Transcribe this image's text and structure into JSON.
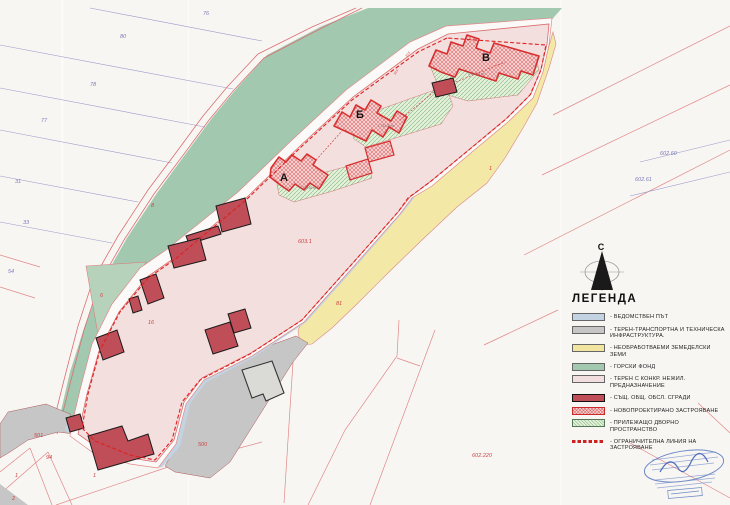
{
  "compass": {
    "label": "С"
  },
  "legend": {
    "title": "ЛЕГЕНДА",
    "items": [
      {
        "swatch": "road",
        "label": "- ВЕДОМСТВЕН ПЪТ"
      },
      {
        "swatch": "infra",
        "label": "- ТЕРЕН-ТРАНСПОРТНА И ТЕХНИЧЕСКА ИНФРАСТРУКТУРА."
      },
      {
        "swatch": "agri",
        "label": "- НЕОБРАБОТВАЕМИ ЗЕМЕДЕЛСКИ ЗЕМИ"
      },
      {
        "swatch": "forest",
        "label": "- ГОРСКИ ФОНД"
      },
      {
        "swatch": "terrain",
        "label": "- ТЕРЕН С КОНКР. НЕЖИЛ. ПРЕДНАЗНАЧЕНИЕ"
      },
      {
        "swatch": "existing",
        "label": "- СЪЩ. ОБЩ. ОБСЛ. СГРАДИ"
      },
      {
        "swatch": "new",
        "label": "- НОВОПРОЕКТИРАНО ЗАСТРОЯВАНЕ"
      },
      {
        "swatch": "yard",
        "label": "- ПРИЛЕЖАЩО ДВОРНО ПРОСТРАНСТВО"
      },
      {
        "swatch": "limit",
        "label": "- ОГРАНИЧИТЕЛНА ЛИНИЯ НА ЗАСТРОЯВАНЕ"
      }
    ]
  },
  "map": {
    "labels": [
      {
        "text": "76",
        "x": 203,
        "y": 15,
        "cls": "parcel-blue"
      },
      {
        "text": "80",
        "x": 120,
        "y": 38,
        "cls": "parcel-blue"
      },
      {
        "text": "78",
        "x": 90,
        "y": 86,
        "cls": "parcel-blue"
      },
      {
        "text": "77",
        "x": 41,
        "y": 122,
        "cls": "parcel-blue"
      },
      {
        "text": "31",
        "x": 15,
        "y": 183,
        "cls": "parcel-blue"
      },
      {
        "text": "33",
        "x": 23,
        "y": 224,
        "cls": "parcel-blue"
      },
      {
        "text": "54",
        "x": 8,
        "y": 273,
        "cls": "parcel-blue"
      },
      {
        "text": "602.60",
        "x": 660,
        "y": 155,
        "cls": "parcel-blue"
      },
      {
        "text": "602.61",
        "x": 635,
        "y": 181,
        "cls": "parcel-blue"
      },
      {
        "text": "8",
        "x": 151,
        "y": 207,
        "cls": "parcel-red"
      },
      {
        "text": "6",
        "x": 100,
        "y": 297,
        "cls": "parcel-red"
      },
      {
        "text": "16",
        "x": 148,
        "y": 324,
        "cls": "parcel-red"
      },
      {
        "text": "603.1",
        "x": 298,
        "y": 243,
        "cls": "parcel-red"
      },
      {
        "text": "81",
        "x": 336,
        "y": 305,
        "cls": "parcel-red"
      },
      {
        "text": "1",
        "x": 489,
        "y": 170,
        "cls": "parcel-red"
      },
      {
        "text": "501",
        "x": 34,
        "y": 437,
        "cls": "parcel-red"
      },
      {
        "text": "94",
        "x": 46,
        "y": 459,
        "cls": "parcel-red"
      },
      {
        "text": "1",
        "x": 15,
        "y": 477,
        "cls": "parcel-red"
      },
      {
        "text": "2",
        "x": 12,
        "y": 500,
        "cls": "parcel-red"
      },
      {
        "text": "1",
        "x": 93,
        "y": 477,
        "cls": "parcel-red"
      },
      {
        "text": "500",
        "x": 198,
        "y": 446,
        "cls": "parcel-red"
      },
      {
        "text": "602.220",
        "x": 472,
        "y": 457,
        "cls": "parcel-red"
      },
      {
        "text": "А",
        "x": 280,
        "y": 181,
        "cls": "building"
      },
      {
        "text": "Б",
        "x": 356,
        "y": 118,
        "cls": "building"
      },
      {
        "text": "В",
        "x": 482,
        "y": 61,
        "cls": "building"
      },
      {
        "text": "1 738.56 м²",
        "x": 300,
        "y": 189,
        "cls": "area"
      },
      {
        "text": "1 732.30 м²",
        "x": 378,
        "y": 127,
        "cls": "area"
      },
      {
        "text": "1 486.14 м²",
        "x": 468,
        "y": 75,
        "cls": "area"
      },
      {
        "text": "20.5",
        "x": 407,
        "y": 57,
        "cls": "dim",
        "rot": -55
      },
      {
        "text": "18.0",
        "x": 395,
        "y": 75,
        "cls": "dim",
        "rot": -55
      }
    ]
  },
  "colors": {
    "paper": "#f8f6f3",
    "forest_green": "#a3c8b0",
    "site_pink": "#f2dfde",
    "agri_yellow": "#f3e8a6",
    "road_blue": "#c3d3e2",
    "infra_gray": "#c6c6c6",
    "existing_building_red": "#bf4e58",
    "boundary_red": "#d63030",
    "label_red": "#cc4444",
    "label_blue": "#7a7ab8",
    "stamp_blue": "#5577c0"
  }
}
